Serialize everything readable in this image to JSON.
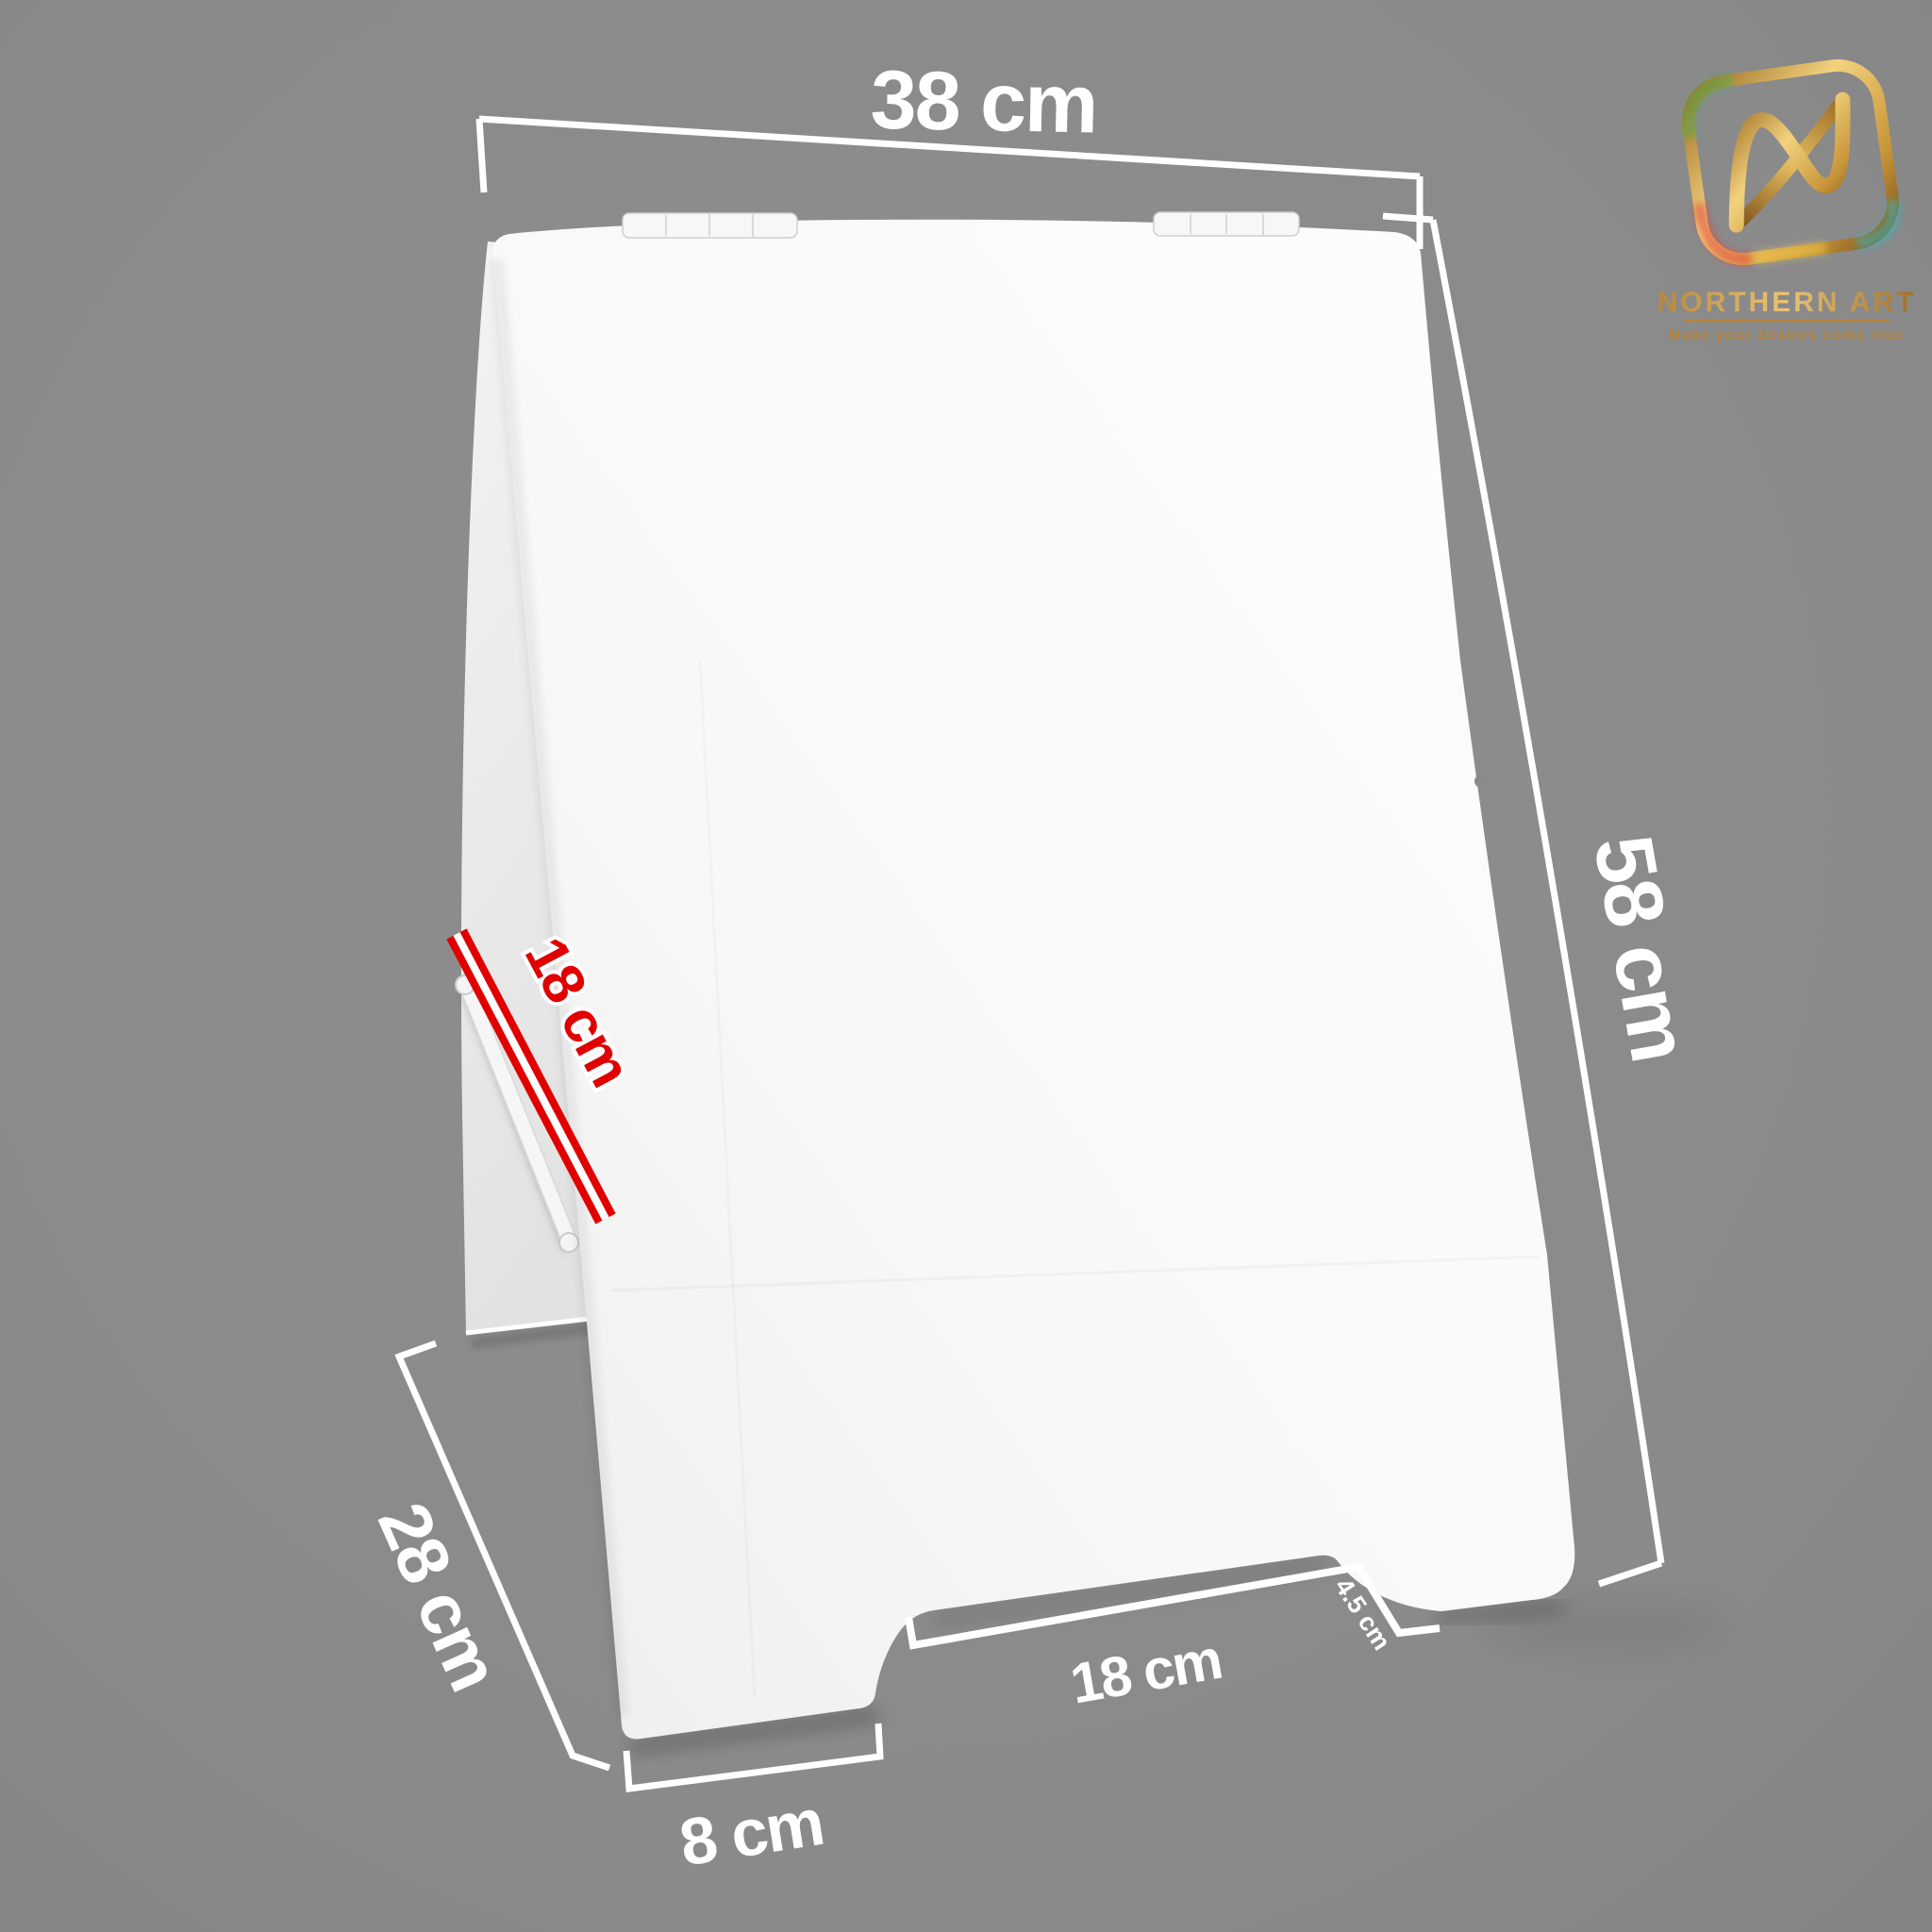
{
  "scene": {
    "background_color": "#8a8a8a",
    "sign_color": "#f7f7f7",
    "dimension_line_color": "#ffffff"
  },
  "dimensions": {
    "top_width": {
      "label": "38 cm"
    },
    "side_height": {
      "label": "58 cm"
    },
    "support_strap": {
      "label": "18 cm",
      "color": "#e10000"
    },
    "base_depth": {
      "label": "28 cm"
    },
    "foot_width": {
      "label": "8 cm"
    },
    "notch_width": {
      "label": "18 cm"
    },
    "notch_height": {
      "label": "4.5 cm"
    }
  },
  "logo": {
    "name": "NORTHERN ART",
    "tagline": "Make your desires come true",
    "gold_color": "#c6933b"
  }
}
